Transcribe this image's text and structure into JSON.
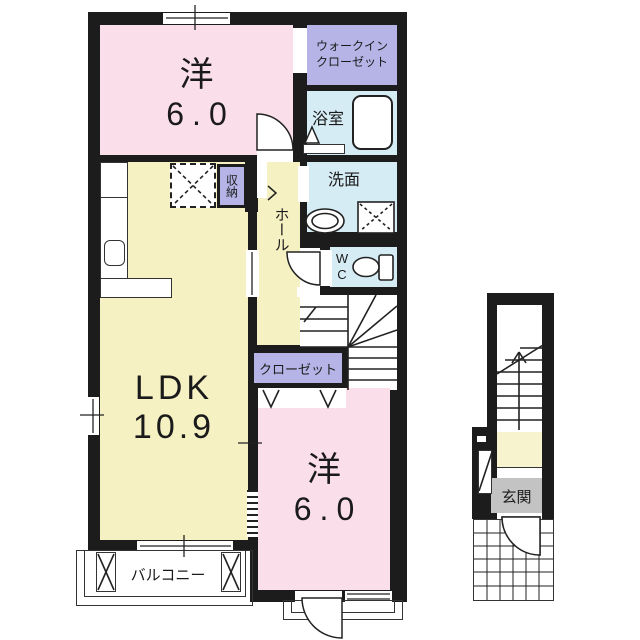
{
  "title": "2F floor plan",
  "colors": {
    "wall": "#1c1c1c",
    "room_pink": "#fadee9",
    "room_yellow": "#f6f1c3",
    "room_blue": "#d6ecf5",
    "room_lavender": "#b6b4e7",
    "genkan_gray": "#c3c3c3",
    "landing_yellow": "#f8f3cf",
    "line": "#222222"
  },
  "rooms": {
    "bedroom_top": {
      "name": "洋",
      "size": "6.0"
    },
    "walk_in_closet": {
      "line1": "ウォークイン",
      "line2": "クローゼット"
    },
    "bath": {
      "name": "浴室"
    },
    "washroom": {
      "name": "洗面"
    },
    "toilet": {
      "line1": "W",
      "line2": "C"
    },
    "storage": {
      "name": "収納"
    },
    "hall": {
      "name": "ホール"
    },
    "ldk": {
      "name": "LDK",
      "size": "10.9"
    },
    "closet": {
      "name": "クローゼット"
    },
    "bedroom_bottom": {
      "name": "洋",
      "size": "6.0"
    },
    "balcony": {
      "name": "バルコニー"
    },
    "entrance": {
      "name": "玄関"
    }
  }
}
